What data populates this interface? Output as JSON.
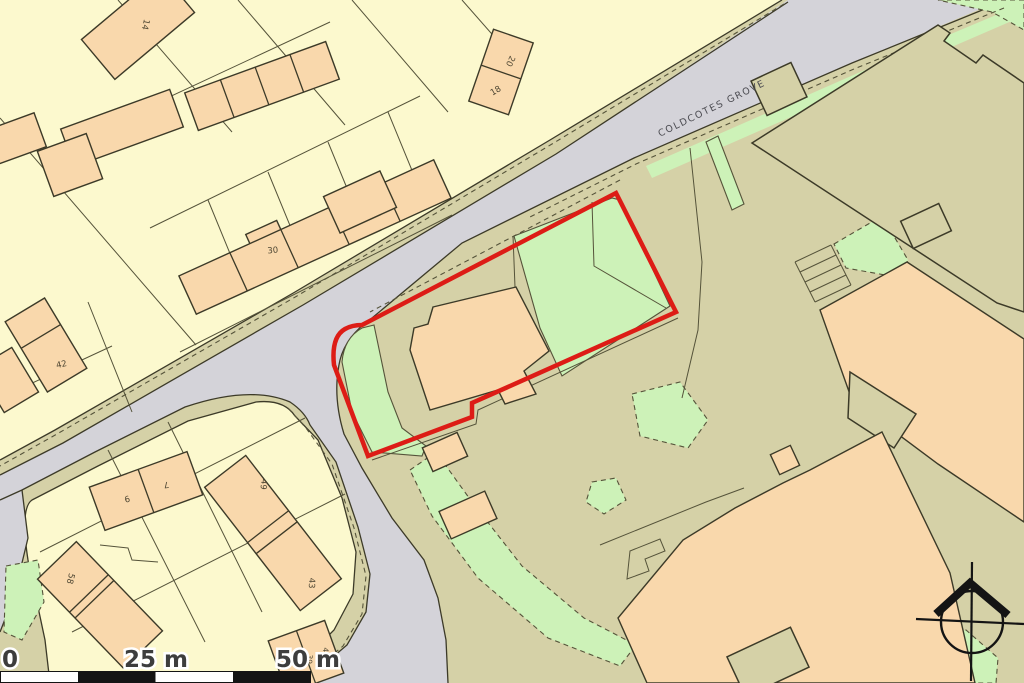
{
  "map": {
    "type": "ordnance-survey-site-plan",
    "street_name": "COLDCOTES GROVE",
    "house_numbers": [
      "14",
      "20",
      "18",
      "30",
      "42",
      "6",
      "7",
      "49",
      "58",
      "43",
      "39",
      "41"
    ],
    "site_boundary": {
      "color": "#dd1c16",
      "shape": "red outlined plot south of Coldcotes Grove"
    }
  },
  "scale_bar": {
    "labels": [
      "0",
      "25 m",
      "50 m"
    ],
    "bar_color": "#141414"
  },
  "compass": {
    "type": "north-arrow"
  },
  "colors": {
    "ground": "#d5d1a7",
    "parcel": "#fcf9ce",
    "road": "#d4d3d9",
    "grass": "#cdf2b8",
    "building": "#f9d8ac",
    "line": "#3c3a28",
    "line2": "#55533a",
    "boundary": "#dd1c16",
    "numtext": "#4f4733",
    "streettext": "#4b4b51",
    "scaletext": "#3d3d3d",
    "barink": "#141414"
  }
}
